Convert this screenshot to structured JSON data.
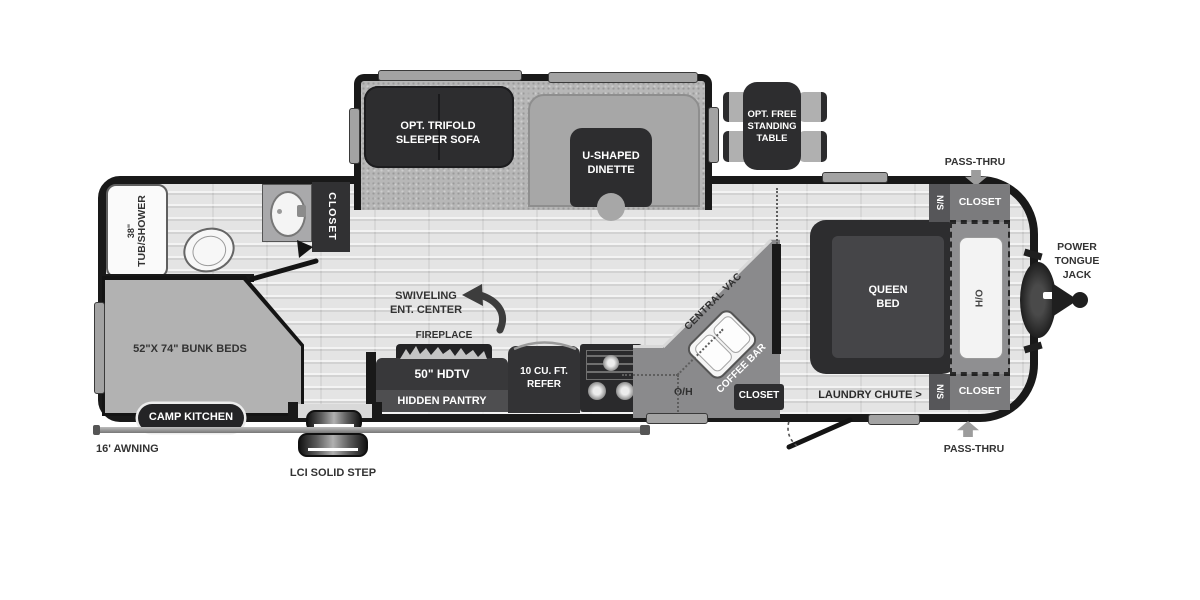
{
  "floorplan": {
    "slideout": {
      "sofa": "OPT. TRIFOLD SLEEPER SOFA",
      "dinette": "U-SHAPED DINETTE"
    },
    "exterior": {
      "free_table": "OPT. FREE STANDING TABLE",
      "pass_thru_top": "PASS-THRU",
      "pass_thru_bottom": "PASS-THRU",
      "power_jack": "POWER TONGUE JACK",
      "awning": "16' AWNING",
      "step": "LCI SOLID STEP",
      "camp_kitchen": "CAMP KITCHEN"
    },
    "bathroom": {
      "tub_size": "38\"",
      "tub": "TUB/SHOWER",
      "closet": "CLOSET"
    },
    "bunks": {
      "label": "52\"X 74\" BUNK BEDS"
    },
    "living": {
      "swivel_line1": "SWIVELING",
      "swivel_line2": "ENT. CENTER",
      "fireplace": "FIREPLACE",
      "hdtv": "50\" HDTV",
      "pantry": "HIDDEN PANTRY",
      "refer": "10 CU. FT. REFER"
    },
    "kitchen": {
      "central_vac": "CENTRAL VAC",
      "coffee_bar": "COFFEE BAR",
      "oh": "O/H",
      "closet": "CLOSET"
    },
    "bedroom": {
      "queen": "QUEEN BED",
      "ho": "H/O",
      "ns_top": "N/S",
      "ns_bottom": "N/S",
      "closet_top": "CLOSET",
      "closet_bottom": "CLOSET",
      "laundry": "LAUNDRY CHUTE >"
    },
    "colors": {
      "shell": "#191919",
      "floor": "#e4e4e4",
      "carpet": "#b7b7b7",
      "furniture_dark": "#2d2d2f",
      "counter_gray": "#8a8a8c",
      "label_dark": "#333333",
      "label_light": "#ffffff"
    }
  }
}
